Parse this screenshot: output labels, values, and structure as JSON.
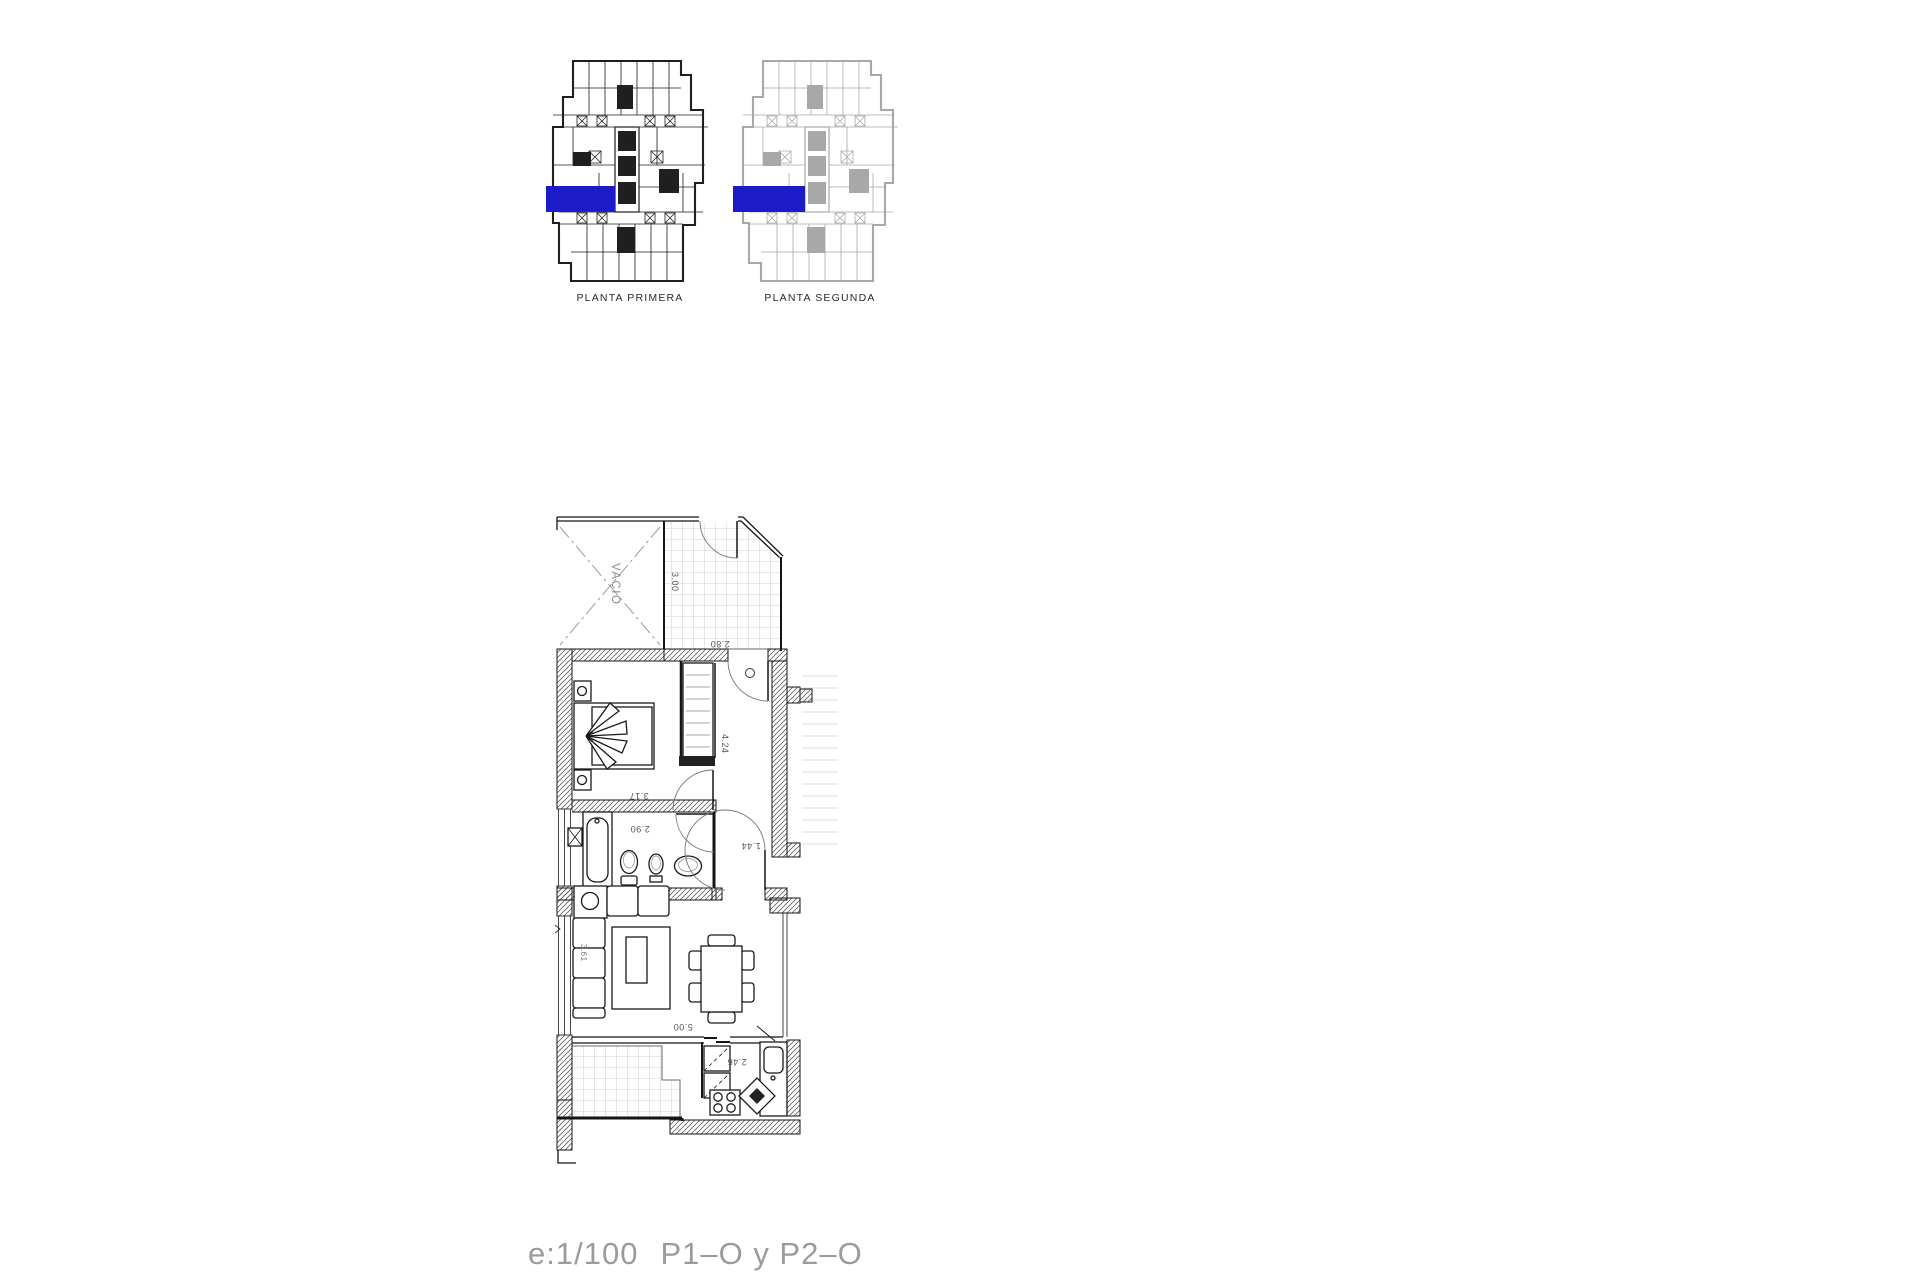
{
  "header": {
    "plans": [
      {
        "label": "PLANTA PRIMERA"
      },
      {
        "label": "PLANTA SEGUNDA"
      }
    ],
    "highlight_color": "#1b1bc8"
  },
  "apartment": {
    "void_label": "VACIO",
    "dimensions": {
      "terrace_height": "3.00",
      "terrace_width": "2.80",
      "bedroom_width": "3.17",
      "hall_length": "4.24",
      "bathroom_width": "2.90",
      "hall_width": "1.44",
      "living_width": "5.00",
      "living_height": "3.61",
      "kitchen_width": "2.46"
    }
  },
  "footer": {
    "scale": "e:1/100",
    "plan_codes": "P1–O y P2–O"
  }
}
